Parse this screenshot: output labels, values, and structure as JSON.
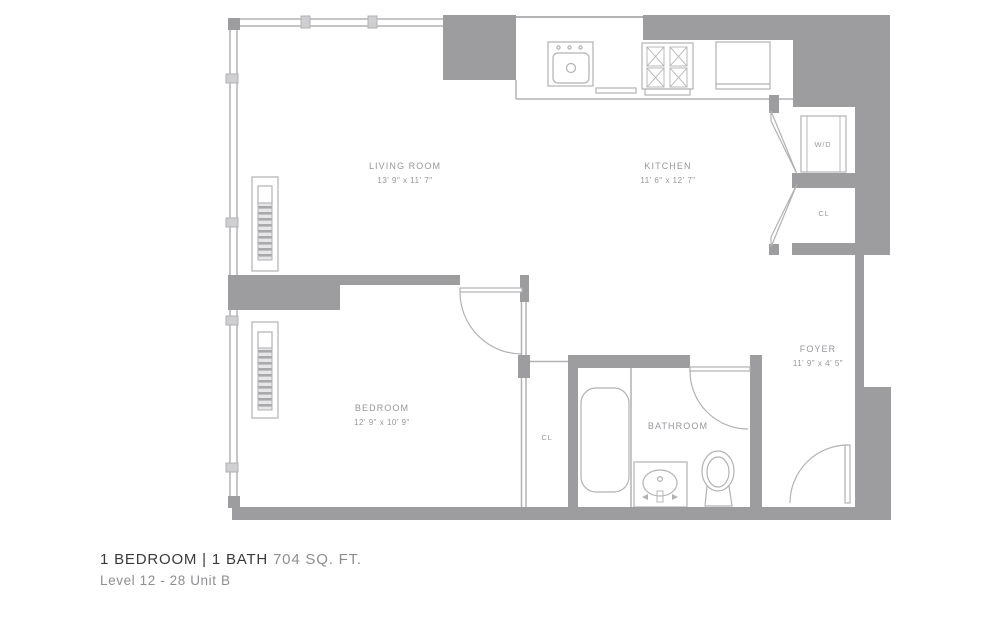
{
  "rooms": {
    "living_room": {
      "label": "LIVING ROOM",
      "dims": "13' 9\" x 11' 7\""
    },
    "kitchen": {
      "label": "KITCHEN",
      "dims": "11' 6\" x 12' 7\""
    },
    "bedroom": {
      "label": "BEDROOM",
      "dims": "12' 9\" x 10' 9\""
    },
    "bathroom": {
      "label": "BATHROOM"
    },
    "foyer": {
      "label": "FOYER",
      "dims": "11' 9\" x 4' 5\""
    },
    "washer_dryer": {
      "label": "W/D"
    },
    "closet_foyer": {
      "label": "CL"
    },
    "closet_bedroom": {
      "label": "CL"
    }
  },
  "footer": {
    "title_main": "1 BEDROOM | 1 BATH",
    "title_area": "704 SQ. FT.",
    "subtitle": "Level 12 - 28 Unit B"
  },
  "colors": {
    "wall": "#9d9da0",
    "thin_line": "#b2b2b4",
    "label_text": "#97979b",
    "title_text": "#3a3a3d",
    "muted_text": "#8e8e92"
  }
}
